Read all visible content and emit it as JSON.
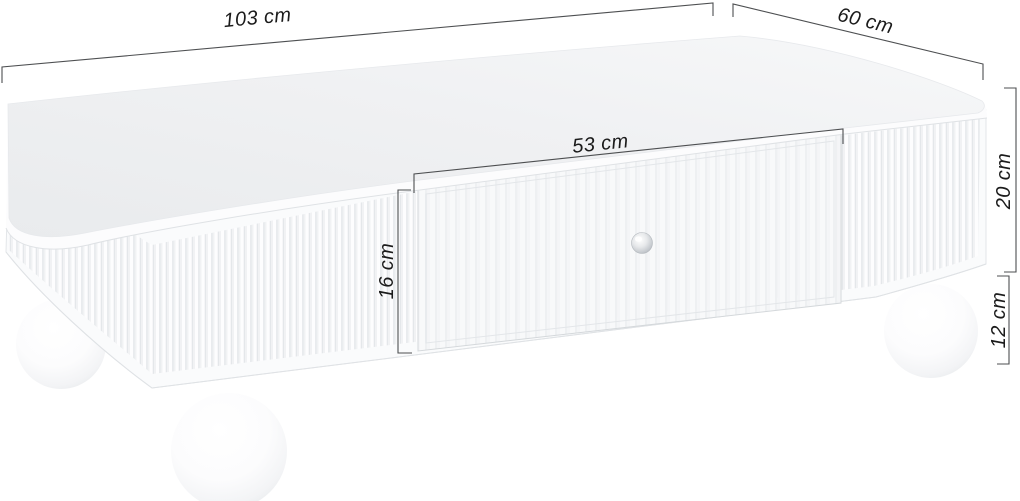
{
  "diagram": {
    "kind": "product-dimension-diagram",
    "subject": "white coffee table with fluted panels, central drawer and ball feet",
    "background_color": "#ffffff"
  },
  "dimensions": {
    "overall_width": {
      "label": "103 cm",
      "meaning": "table top width"
    },
    "overall_depth": {
      "label": "60 cm",
      "meaning": "table top depth"
    },
    "drawer_width": {
      "label": "53 cm",
      "meaning": "drawer front width"
    },
    "drawer_height": {
      "label": "16 cm",
      "meaning": "drawer front height"
    },
    "body_height": {
      "label": "20 cm",
      "meaning": "carcass side height"
    },
    "leg_height": {
      "label": "12 cm",
      "meaning": "ball foot height"
    }
  },
  "style": {
    "dimension_line_color": "#4d4f51",
    "dimension_text_color": "#1b1b1b",
    "table_color": "#ffffff",
    "table_shade_color": "#ececee",
    "knob_color": "#c0c4c9"
  }
}
